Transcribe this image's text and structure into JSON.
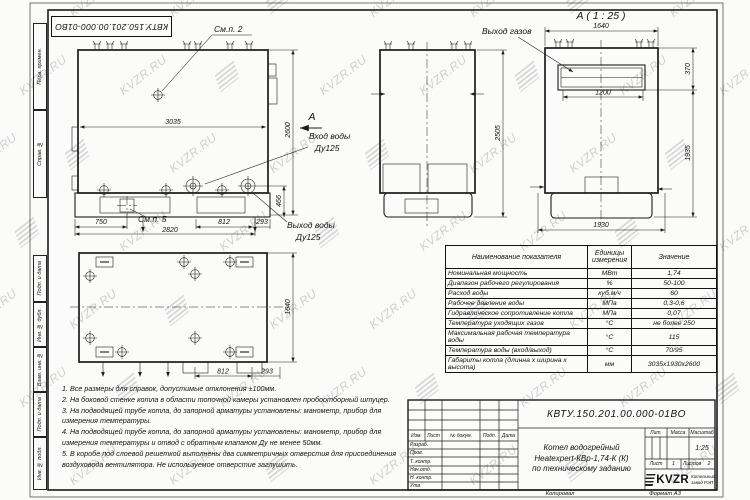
{
  "sheet": {
    "doc_number": "КВТУ.150.201.00.000-01ВО",
    "copied_label": "Копировал",
    "format_label": "Формат А3"
  },
  "watermark": {
    "text": "KVZR.RU"
  },
  "margin_labels": [
    "Перв. примен.",
    "Справ. №",
    "Подп. и дата",
    "Инв. № дубл.",
    "Взам. инв. №",
    "Подп. и дата",
    "Инв. № подл."
  ],
  "views": {
    "front": {
      "callout_top": "См.п. 2",
      "callout_base": "См.п. 5",
      "width": "3035",
      "height": "2600",
      "dim_750": "750",
      "dim_2820": "2820",
      "dim_812": "812",
      "dim_293": "293",
      "dim_466": "466",
      "section_arrow": "А",
      "inlet_line1": "Вход воды",
      "inlet_line2": "Ду125",
      "outlet_line1": "Выход воды",
      "outlet_line2": "Ду125"
    },
    "side": {
      "height": "2505"
    },
    "viewA": {
      "title": "А ( 1 : 25 )",
      "gas_label": "Выход газов",
      "width": "1640",
      "outlet_width": "1200",
      "outlet_height": "370",
      "lower_height": "1935",
      "base_width": "1930"
    },
    "plan": {
      "depth": "1640",
      "dim_812": "812",
      "dim_293": "293"
    }
  },
  "spec_table": {
    "headers": [
      "Наименование показателя",
      "Единицы измерения",
      "Значение"
    ],
    "rows": [
      {
        "name": "Номинальная мощность",
        "unit": "МВт",
        "value": "1,74"
      },
      {
        "name": "Диапазон рабочего регулирования",
        "unit": "%",
        "value": "50-100"
      },
      {
        "name": "Расход воды",
        "unit": "куб.м/ч",
        "value": "60"
      },
      {
        "name": "Рабочее давление воды",
        "unit": "МПа",
        "value": "0,3-0,6"
      },
      {
        "name": "Гидравлическое сопротивление котла",
        "unit": "МПа",
        "value": "0,07"
      },
      {
        "name": "Температура уходящих газов",
        "unit": "°С",
        "value": "не более 250"
      },
      {
        "name": "Максимальная рабочая температура воды",
        "unit": "°С",
        "value": "115"
      },
      {
        "name": "Температура воды (вход/выход)",
        "unit": "°С",
        "value": "70/95"
      },
      {
        "name": "Габариты котла (длинна х ширина х высота)",
        "unit": "мм",
        "value": "3035х1930х2600"
      }
    ]
  },
  "notes": [
    "1. Все размеры для справок, допустимые отклонения ±100мм.",
    "2. На боковой стенке котла в области топочной камеры установлен пробоотборный штуцер.",
    "3. На подводящей трубе котла, до запорной арматуры установлены: манометр, прибор для измерения температуры.",
    "4. На подводящей трубе котла, до запорной арматуры установлены: манометр, прибор для измерения температуры и отвод с обратным клапаном Ду не менее 50мм.",
    "5. В коробе под слоевой решеткой выполнены два симметричных отверстия для присоединения воздуховода вентилятора. Не используемое отверстие заглушить."
  ],
  "title_block": {
    "header_cols": [
      "Изм.",
      "Лист",
      "№ докум.",
      "Подп.",
      "Дата"
    ],
    "signature_rows": [
      "Разраб.",
      "Пров.",
      "Т. контр.",
      "Нач.отд.",
      "Н. контр.",
      "Утв."
    ],
    "product_name_lines": [
      "Котел водогрейный",
      "Heatexpert-КВр-1,74-К (К)",
      "по техническому заданию"
    ],
    "lit_label": "Лит.",
    "mass_label": "Масса",
    "scale_label": "Масштаб",
    "scale_value": "1:25",
    "sheet_label": "Лист",
    "sheet_value": "1",
    "sheets_label": "Листов",
    "sheets_value": "2",
    "company": {
      "logo_text": "KVZR",
      "tagline_line1": "Котельный",
      "tagline_line2": "завод РЭП"
    }
  }
}
